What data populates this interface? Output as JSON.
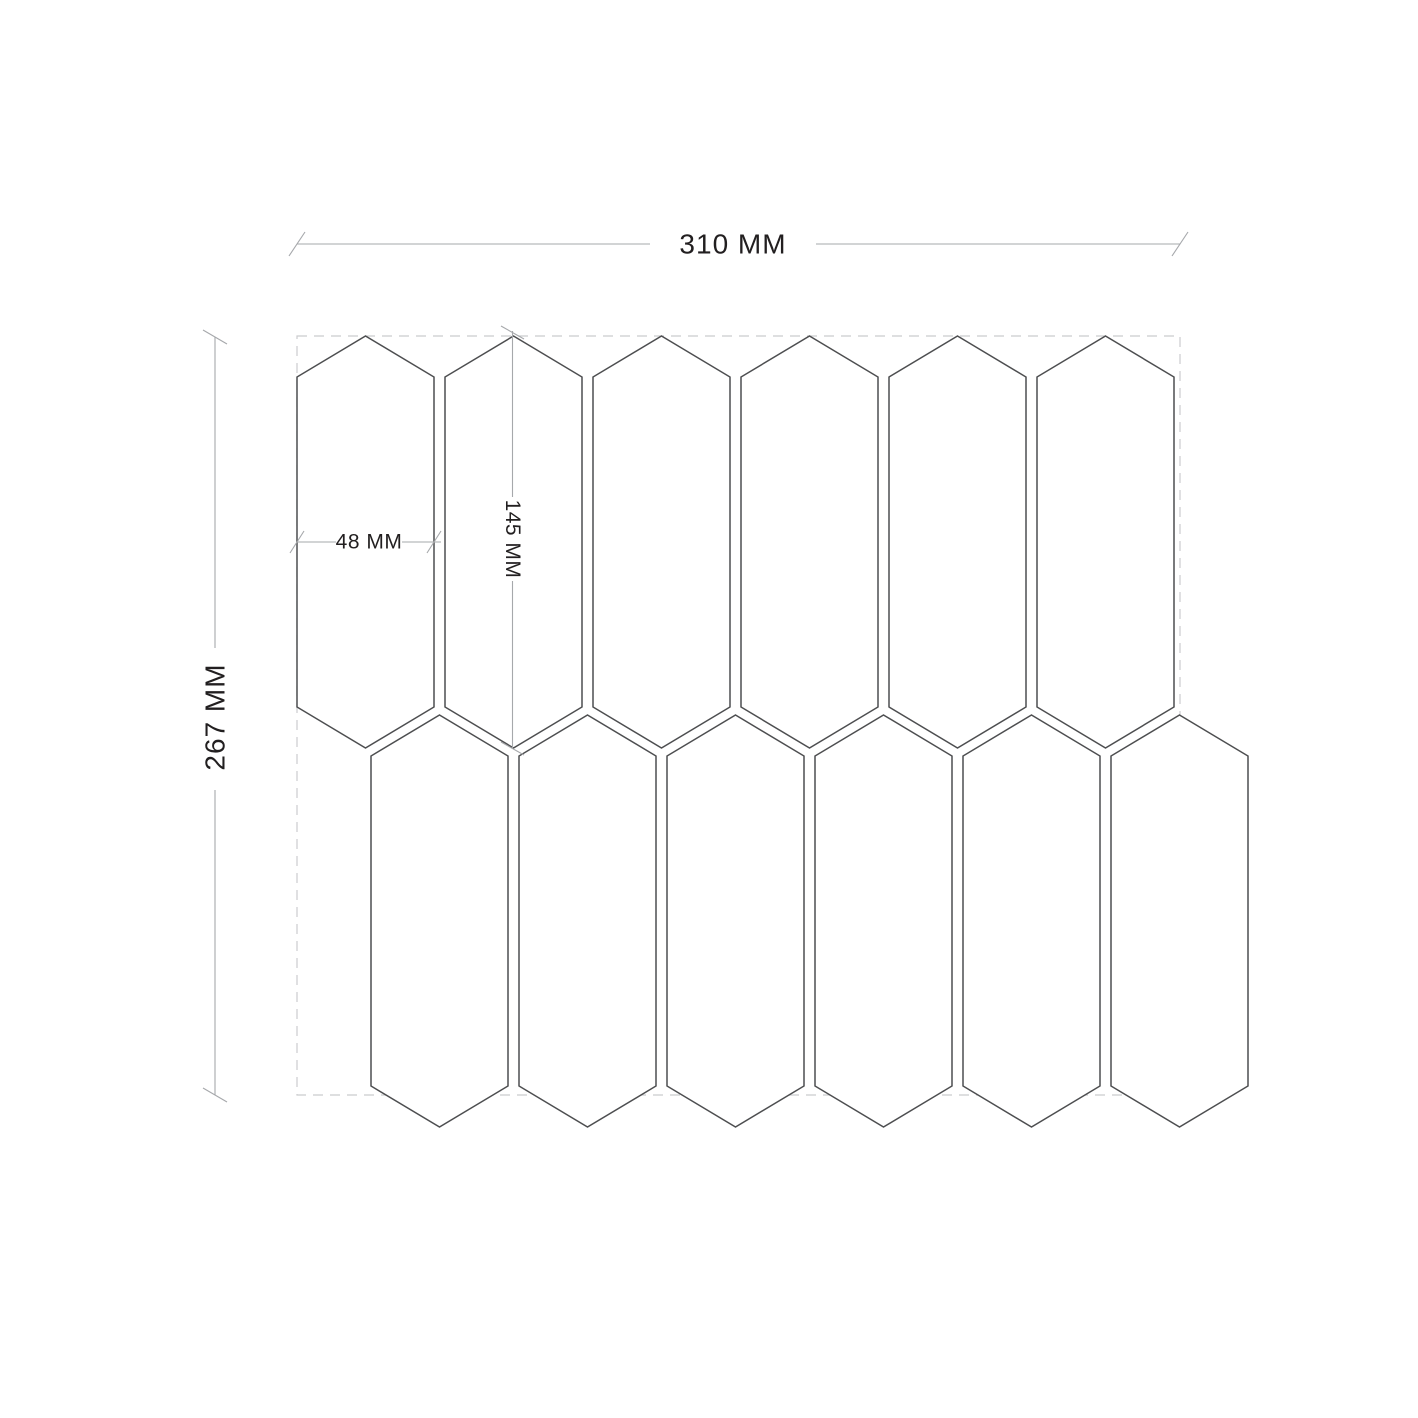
{
  "diagram": {
    "type": "tile-sheet-dimension-drawing",
    "dimensions": {
      "sheet_width": {
        "label": "310 MM",
        "value_mm": 310
      },
      "sheet_height": {
        "label": "267 MM",
        "value_mm": 267
      },
      "tile_width": {
        "label": "48 MM",
        "value_mm": 48
      },
      "tile_height": {
        "label": "145 MM",
        "value_mm": 145
      }
    },
    "mosaic": {
      "tile_shape": "picket-hexagon",
      "rows": 2,
      "tiles_per_row": 6
    },
    "colors": {
      "background": "#ffffff",
      "tile_outline": "#4d4e50",
      "sheet_dashed_border": "#cbccce",
      "dimension_line": "#a6a8ab",
      "label_text": "#221f20"
    }
  }
}
